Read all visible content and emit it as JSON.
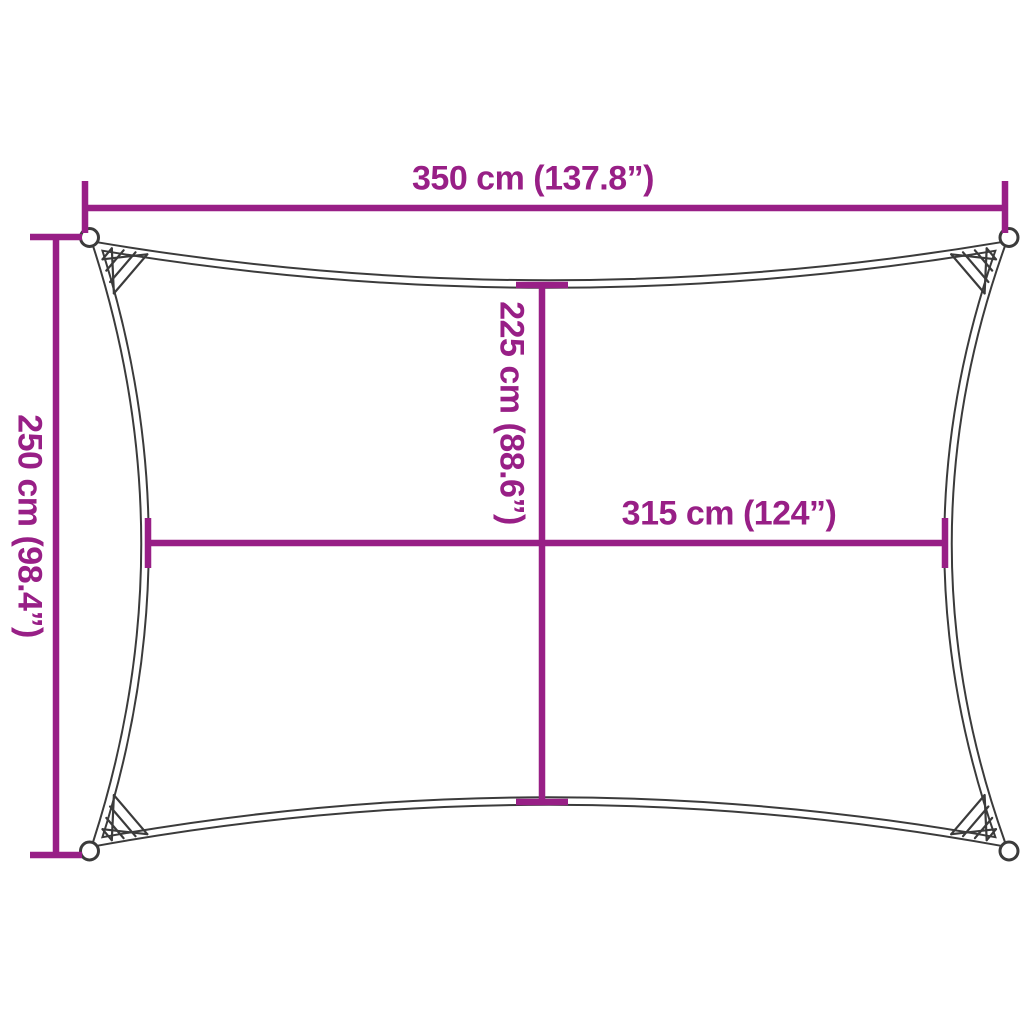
{
  "colors": {
    "accent": "#981F86",
    "outline": "#3B3B3B",
    "background": "#FFFFFF"
  },
  "dimensions": {
    "width_overall": "350 cm (137.8”)",
    "height_overall": "250 cm (98.4”)",
    "height_inner": "225 cm (88.6”)",
    "width_inner": "315 cm (124”)"
  }
}
